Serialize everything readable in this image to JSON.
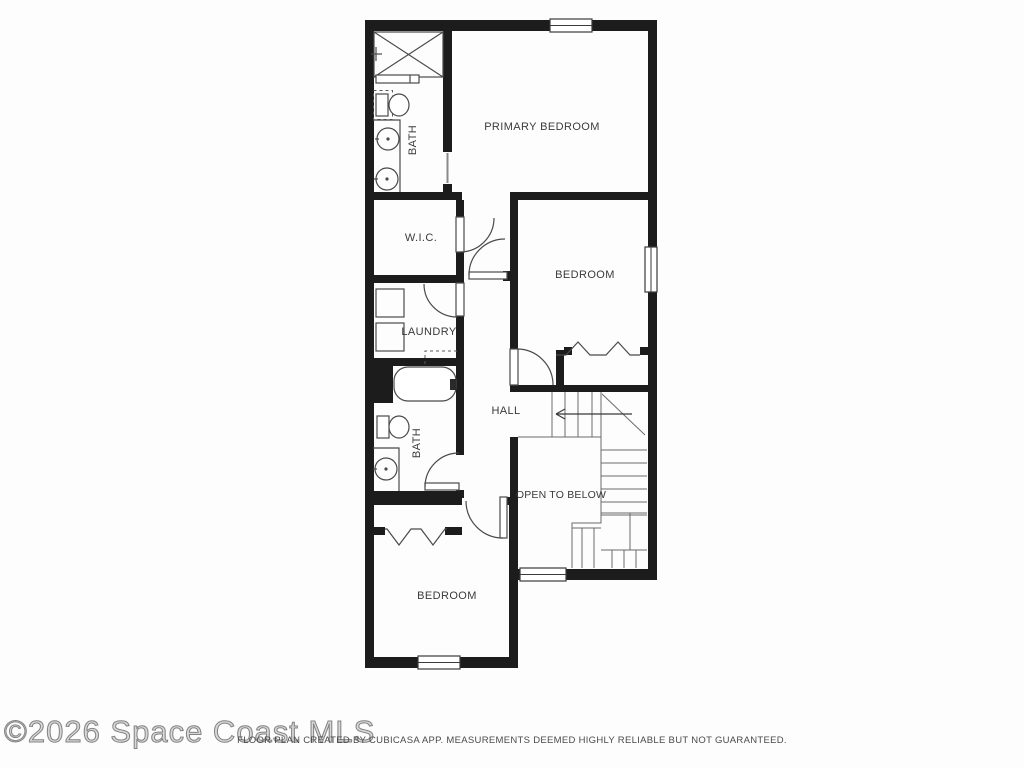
{
  "watermark": "©2026 Space Coast MLS",
  "footer": "FLOOR PLAN CREATED BY CUBICASA APP. MEASUREMENTS DEEMED HIGHLY RELIABLE BUT NOT GUARANTEED.",
  "rooms": {
    "primary_bedroom": {
      "label": "PRIMARY BEDROOM"
    },
    "bath_top": {
      "label": "BATH"
    },
    "wic": {
      "label": "W.I.C."
    },
    "bedroom_middle": {
      "label": "BEDROOM"
    },
    "laundry": {
      "label": "LAUNDRY"
    },
    "bath_lower": {
      "label": "BATH"
    },
    "hall": {
      "label": "HALL"
    },
    "open_to_below": {
      "label": "OPEN TO BELOW"
    },
    "bedroom_bottom": {
      "label": "BEDROOM"
    }
  },
  "fixtures": [
    "shower",
    "shower-door",
    "toilet",
    "double-sink-vanity",
    "single-sink-vanity",
    "bathtub",
    "washer",
    "dryer",
    "bifold-closet-doors",
    "u-shaped-staircase",
    "up-direction-arrow"
  ],
  "windows_count": 4,
  "doors_count": 6,
  "colors": {
    "wall": "#1c1c1c",
    "fixture_line": "#4a4a4a",
    "label_text": "#3a3a3a",
    "watermark_gray": "#828282",
    "footer_text": "#4a4a4a",
    "background": "#fdfdfd"
  }
}
